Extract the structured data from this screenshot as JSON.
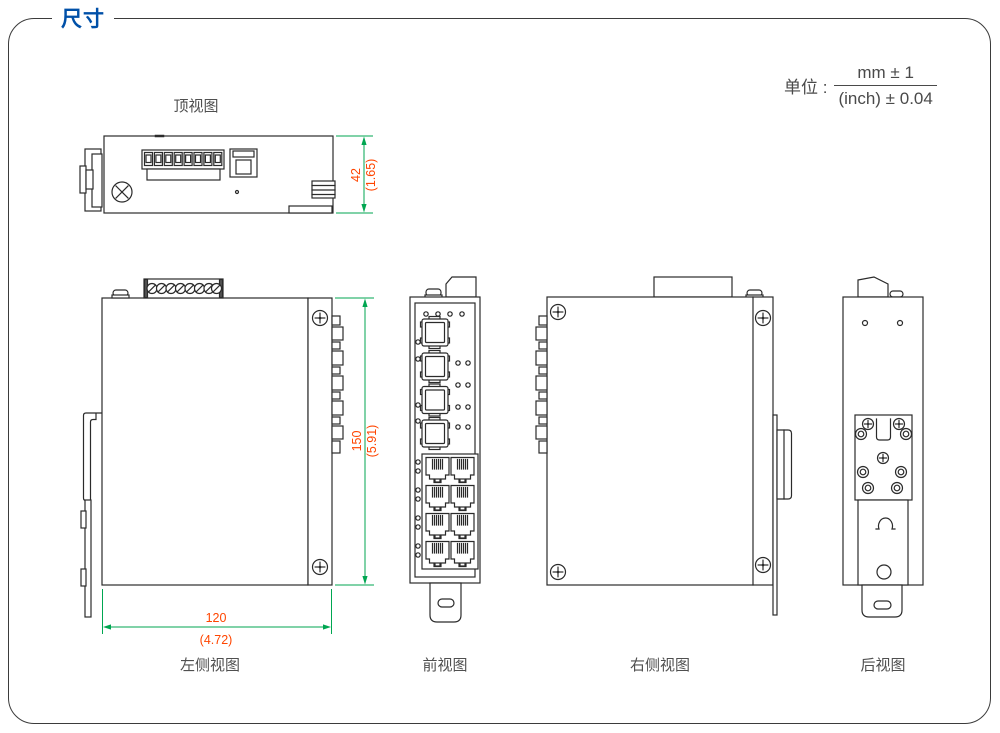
{
  "page": {
    "section_title": "尺寸"
  },
  "units": {
    "prefix": "单位 :",
    "numerator": "mm ± 1",
    "denominator": "(inch) ± 0.04"
  },
  "views": {
    "top": {
      "label": "顶视图"
    },
    "left": {
      "label": "左侧视图"
    },
    "front": {
      "label": "前视图"
    },
    "right": {
      "label": "右侧视图"
    },
    "back": {
      "label": "后视图"
    }
  },
  "dimensions": {
    "height_mm": "42",
    "height_inch": "(1.65)",
    "depth_mm": "150",
    "depth_inch": "(5.91)",
    "width_mm": "120",
    "width_inch": "(4.72)"
  },
  "colors": {
    "accent_blue": "#0050A8",
    "dim_line_green": "#00A651",
    "dim_text_red": "#FF4500",
    "drawing_line": "#2B2B2B"
  }
}
